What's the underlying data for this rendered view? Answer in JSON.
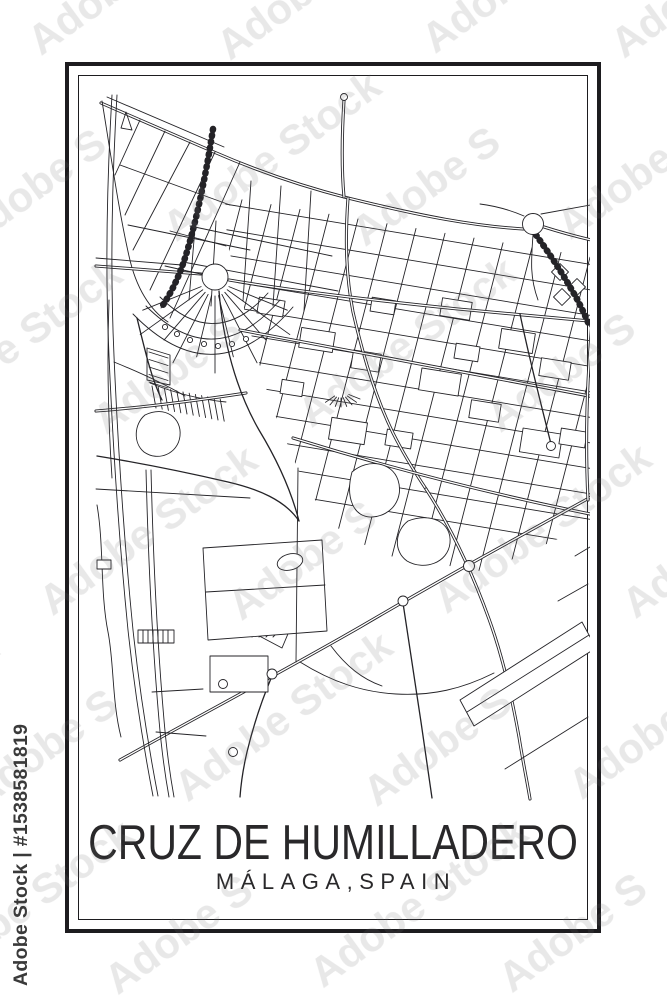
{
  "poster": {
    "title": "CRUZ DE HUMILLADERO",
    "subtitle": "MÁLAGA,SPAIN"
  },
  "watermark": {
    "diagonal_label": "Adobe Stock",
    "side_label": "Adobe Stock | #1538581819"
  },
  "colors": {
    "background": "#ffffff",
    "map_lines": "#242327",
    "frame": "#1d1c1f",
    "title_text": "#29282a",
    "watermark_tile": "#6e6e6e",
    "watermark_side": "#3a3a3a"
  }
}
